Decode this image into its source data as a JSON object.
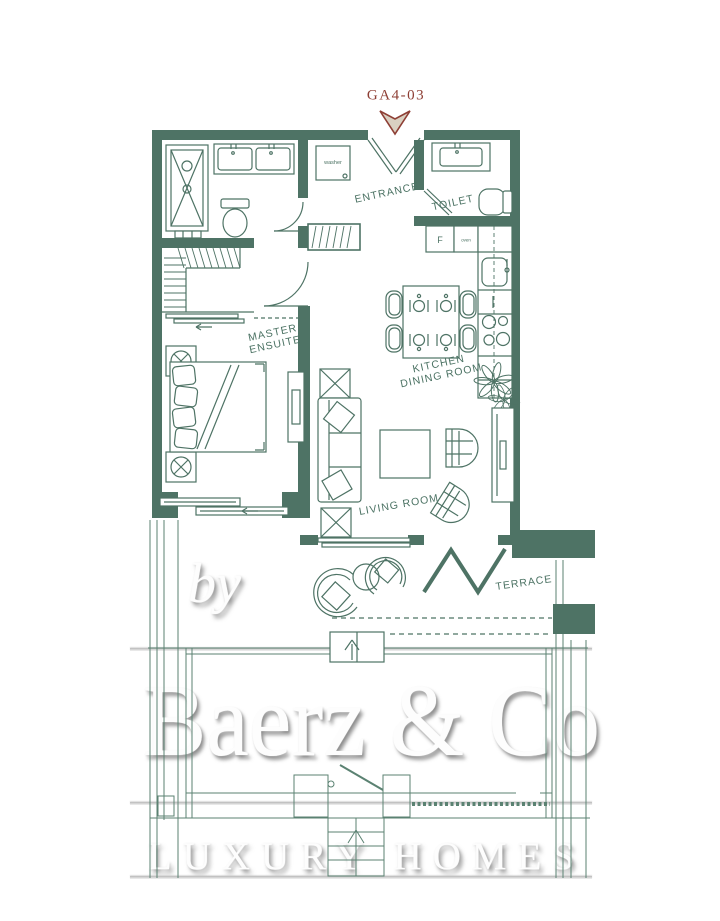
{
  "plan": {
    "unit_label": "GA4-03",
    "room_labels": {
      "entrance": "ENTRANCE",
      "toilet": "TOILET",
      "master_line1": "MASTER",
      "master_line2": "ENSUITE",
      "kitchen_line1": "KITCHEN",
      "kitchen_line2": "DINING ROOM",
      "living_room": "LIVING ROOM",
      "terrace": "TERRACE"
    },
    "fixture_labels": {
      "washer": "washer",
      "fridge": "F",
      "oven": "oven"
    }
  },
  "watermark": {
    "prefix": "by",
    "brand": "Baerz & Co",
    "tagline": "LUXURY HOMES"
  },
  "colors": {
    "wall_green": "#4e7365",
    "line_green": "#5b8272",
    "unit_label_red": "#8e3f35",
    "arrow_fill": "#d9d0c1",
    "watermark_white": "#fdfdfd",
    "background": "#ffffff"
  }
}
